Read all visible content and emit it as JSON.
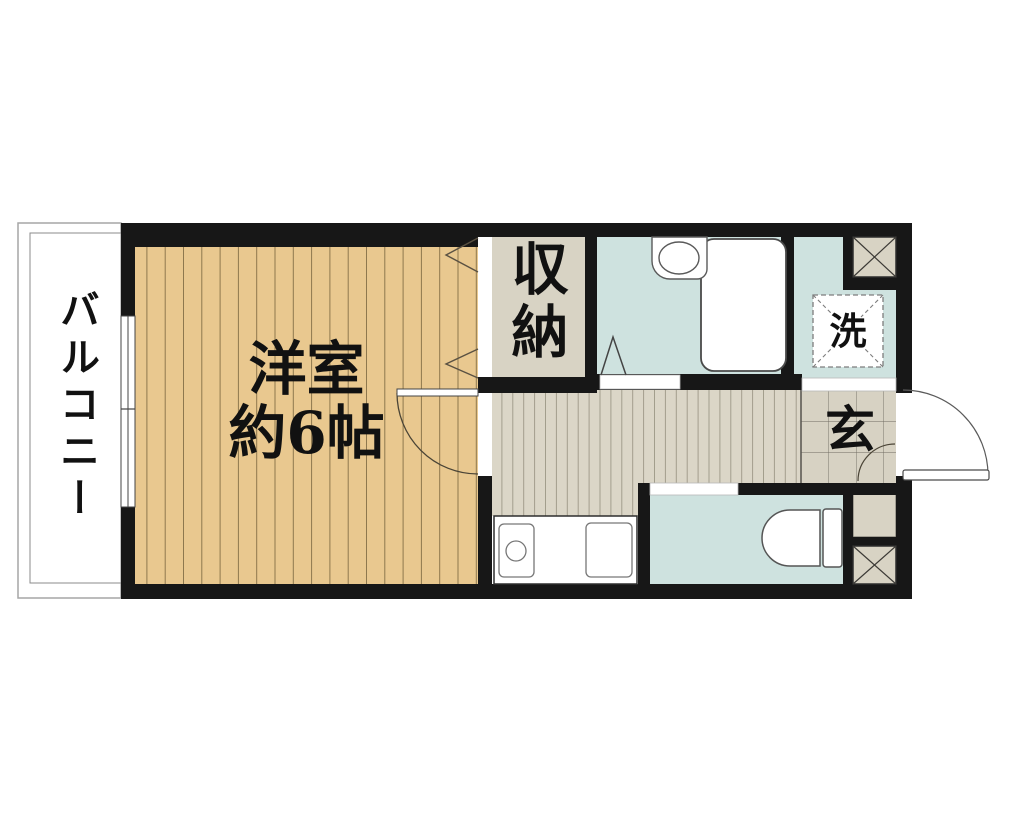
{
  "floorplan": {
    "type": "japanese-apartment-floor-plan",
    "labels": {
      "balcony": "バルコニー",
      "room_name": "洋室",
      "room_size": "約6帖",
      "closet": "収納",
      "laundry": "洗",
      "entrance": "玄"
    },
    "colors": {
      "wall": "#171717",
      "room_floor": "#e9c88f",
      "room_plank_line": "#8d774d",
      "closet_floor": "#d8d3c4",
      "wet_area": "#cee2df",
      "hallway_floor": "#dbd6c7",
      "hallway_line": "#a29d8c",
      "tile_floor": "#d7d2c3",
      "tile_line": "#6f6b61",
      "shaft_box": "#d8d3c4",
      "background": "#ffffff",
      "fixture_outline": "#4a4a4a",
      "balcony_outline": "#999999"
    }
  }
}
